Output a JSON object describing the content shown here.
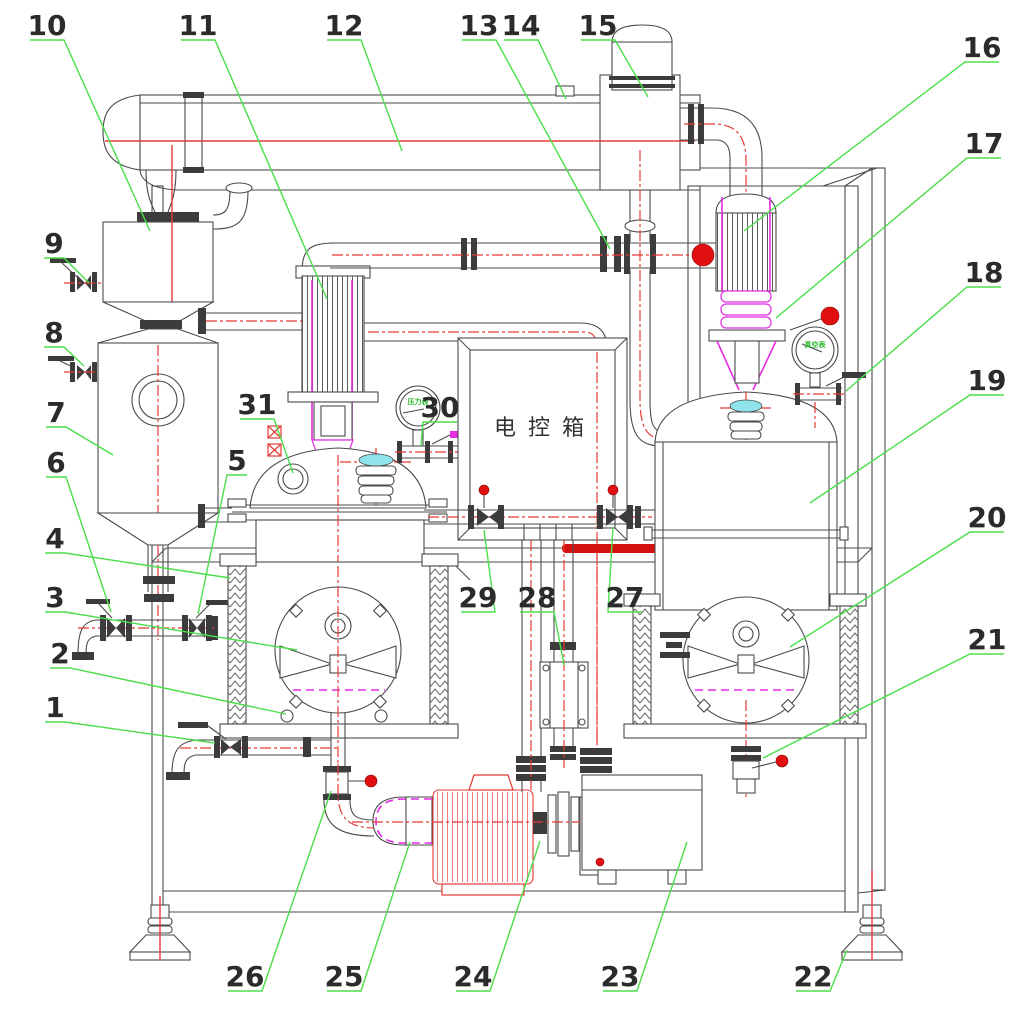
{
  "drawing": {
    "control_box_label": "电控箱",
    "gauge_left_label": "压力表",
    "gauge_right_label": "真空表"
  },
  "colors": {
    "leader_green": "#4adf4a",
    "centerline_red": "#e53935",
    "accent_magenta": "#e32ce3",
    "pump_red": "#e53935",
    "line_gray": "#4a4a4a",
    "funnel_cyan": "#8fe3ea",
    "handle_ball_red": "#e01010",
    "thick_bar_red": "#d31111"
  },
  "callouts": [
    {
      "n": "1",
      "x": 55,
      "y": 706,
      "tx": 215,
      "ty": 743
    },
    {
      "n": "2",
      "x": 60,
      "y": 652,
      "tx": 286,
      "ty": 714
    },
    {
      "n": "3",
      "x": 55,
      "y": 596,
      "tx": 297,
      "ty": 650
    },
    {
      "n": "4",
      "x": 55,
      "y": 537,
      "tx": 230,
      "ty": 578
    },
    {
      "n": "5",
      "x": 237,
      "y": 459,
      "tx": 198,
      "ty": 614
    },
    {
      "n": "6",
      "x": 56,
      "y": 461,
      "tx": 111,
      "ty": 612
    },
    {
      "n": "7",
      "x": 56,
      "y": 411,
      "tx": 113,
      "ty": 455
    },
    {
      "n": "8",
      "x": 54,
      "y": 331,
      "tx": 84,
      "ty": 366
    },
    {
      "n": "9",
      "x": 54,
      "y": 242,
      "tx": 89,
      "ty": 283
    },
    {
      "n": "10",
      "x": 47,
      "y": 24,
      "tx": 150,
      "ty": 231
    },
    {
      "n": "11",
      "x": 198,
      "y": 24,
      "tx": 327,
      "ty": 299
    },
    {
      "n": "12",
      "x": 344,
      "y": 24,
      "tx": 402,
      "ty": 151
    },
    {
      "n": "13",
      "x": 479,
      "y": 24,
      "tx": 610,
      "ty": 249
    },
    {
      "n": "14",
      "x": 521,
      "y": 24,
      "tx": 566,
      "ty": 99
    },
    {
      "n": "15",
      "x": 598,
      "y": 24,
      "tx": 648,
      "ty": 97
    },
    {
      "n": "16",
      "x": 982,
      "y": 46,
      "tx": 744,
      "ty": 231
    },
    {
      "n": "17",
      "x": 984,
      "y": 142,
      "tx": 776,
      "ty": 318
    },
    {
      "n": "18",
      "x": 984,
      "y": 271,
      "tx": 846,
      "ty": 391
    },
    {
      "n": "19",
      "x": 987,
      "y": 379,
      "tx": 810,
      "ty": 503
    },
    {
      "n": "20",
      "x": 987,
      "y": 516,
      "tx": 790,
      "ty": 647
    },
    {
      "n": "21",
      "x": 987,
      "y": 638,
      "tx": 763,
      "ty": 758
    },
    {
      "n": "22",
      "x": 813,
      "y": 975,
      "tx": 847,
      "ty": 950
    },
    {
      "n": "23",
      "x": 620,
      "y": 975,
      "tx": 687,
      "ty": 842
    },
    {
      "n": "24",
      "x": 473,
      "y": 975,
      "tx": 540,
      "ty": 841
    },
    {
      "n": "25",
      "x": 344,
      "y": 975,
      "tx": 410,
      "ty": 842
    },
    {
      "n": "26",
      "x": 245,
      "y": 975,
      "tx": 331,
      "ty": 791
    },
    {
      "n": "27",
      "x": 625,
      "y": 596,
      "tx": 613,
      "ty": 527
    },
    {
      "n": "28",
      "x": 537,
      "y": 596,
      "tx": 564,
      "ty": 665
    },
    {
      "n": "29",
      "x": 478,
      "y": 596,
      "tx": 484,
      "ty": 530
    },
    {
      "n": "30",
      "x": 440,
      "y": 406,
      "tx": 421,
      "ty": 446
    },
    {
      "n": "31",
      "x": 257,
      "y": 403,
      "tx": 293,
      "ty": 473
    }
  ]
}
